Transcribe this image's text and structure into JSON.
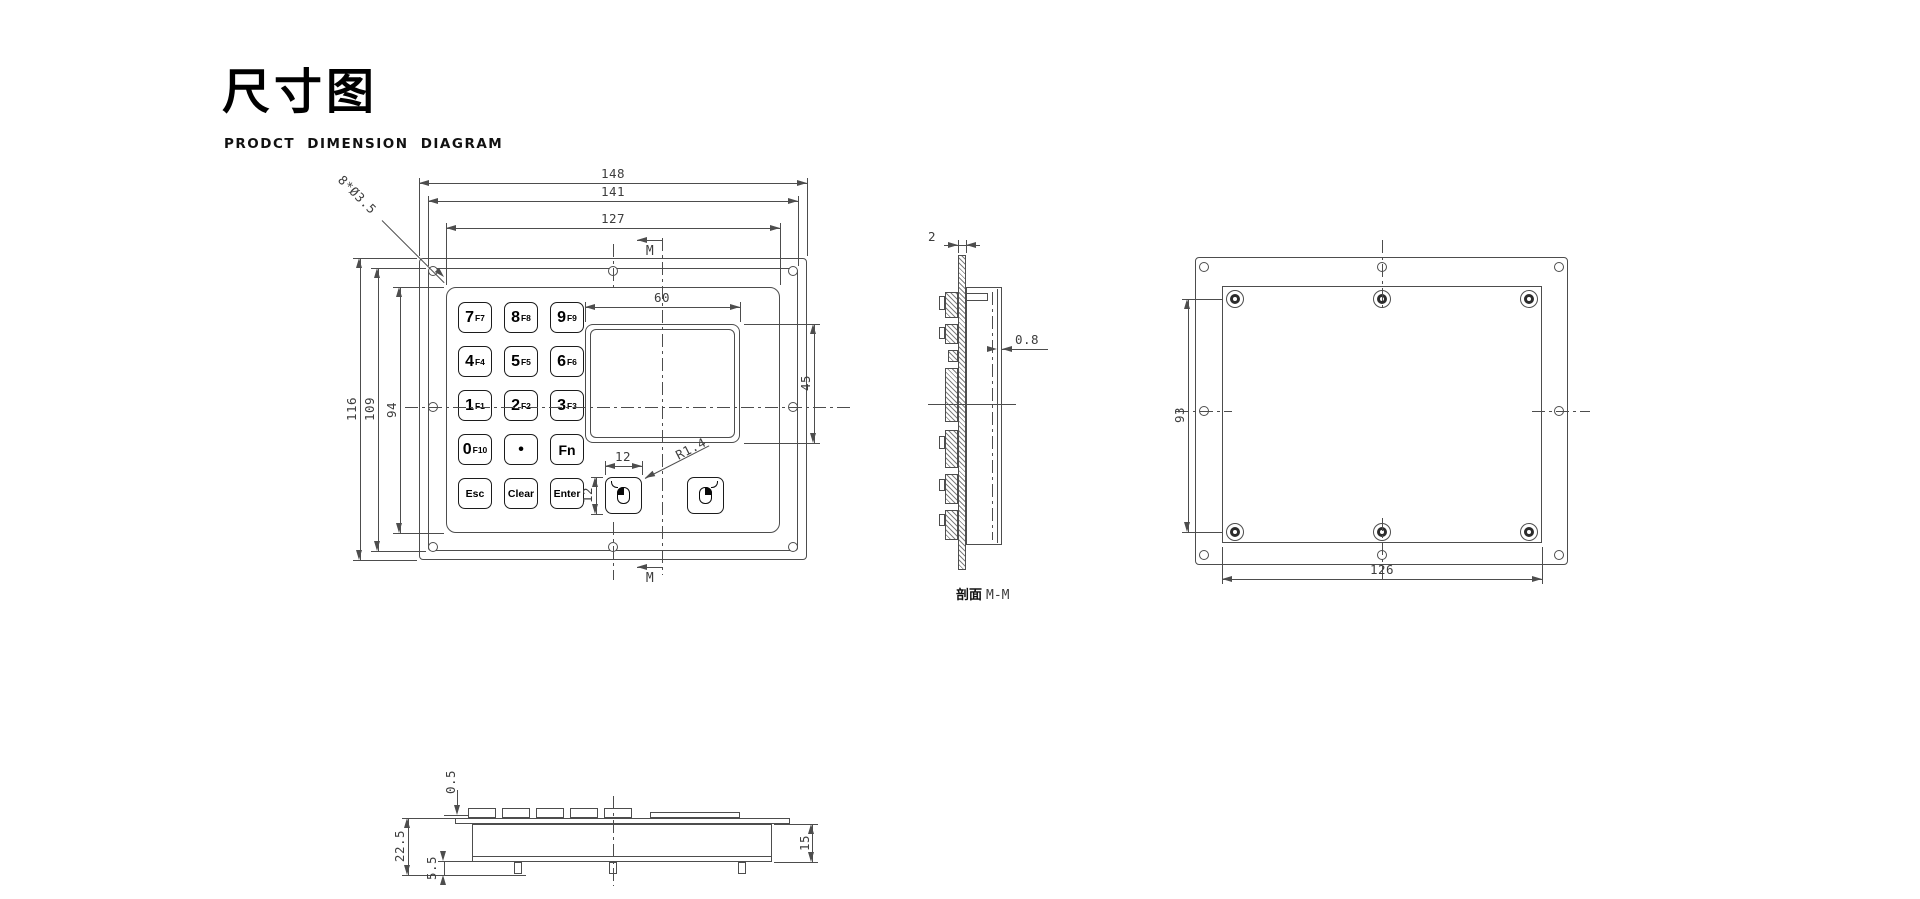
{
  "header": {
    "title": "尺寸图",
    "subtitle": "PRODCT DIMENSION DIAGRAM"
  },
  "front_view": {
    "dims": {
      "overall_width": "148",
      "mid_width": "141",
      "inner_width": "127",
      "overall_height": "116",
      "mid_height": "109",
      "inner_height": "94",
      "touchpad_width": "60",
      "touchpad_height": "45",
      "mouse_key_width": "12",
      "mouse_key_height": "12",
      "corner_radius": "R1.4",
      "hole_callout": "8*Ø3.5",
      "section_top": "M",
      "section_bottom": "M"
    },
    "keys": [
      {
        "main": "7",
        "sub": "F7"
      },
      {
        "main": "8",
        "sub": "F8"
      },
      {
        "main": "9",
        "sub": "F9"
      },
      {
        "main": "4",
        "sub": "F4"
      },
      {
        "main": "5",
        "sub": "F5"
      },
      {
        "main": "6",
        "sub": "F6"
      },
      {
        "main": "1",
        "sub": "F1"
      },
      {
        "main": "2",
        "sub": "F2"
      },
      {
        "main": "3",
        "sub": "F3"
      },
      {
        "main": "0",
        "sub": "F10"
      },
      {
        "main": "•",
        "sub": ""
      },
      {
        "main": "Fn",
        "sub": ""
      },
      {
        "main": "Esc",
        "sub": ""
      },
      {
        "main": "Clear",
        "sub": ""
      },
      {
        "main": "Enter",
        "sub": ""
      }
    ]
  },
  "section_view": {
    "label_cn": "剖面",
    "label_en": "M-M",
    "dims": {
      "panel_thickness": "2",
      "wall_thickness": "0.8"
    }
  },
  "back_view": {
    "dims": {
      "standoff_row_spacing": "93",
      "standoff_col_spacing": "126"
    }
  },
  "bottom_view": {
    "dims": {
      "key_protrusion": "0.5",
      "overall_depth": "22.5",
      "bottom_section": "5.5",
      "body_depth": "15"
    }
  },
  "colors": {
    "line": "#4d4d4d",
    "dim_text": "#3d3d3d",
    "key_text": "#000000",
    "background": "#ffffff"
  }
}
